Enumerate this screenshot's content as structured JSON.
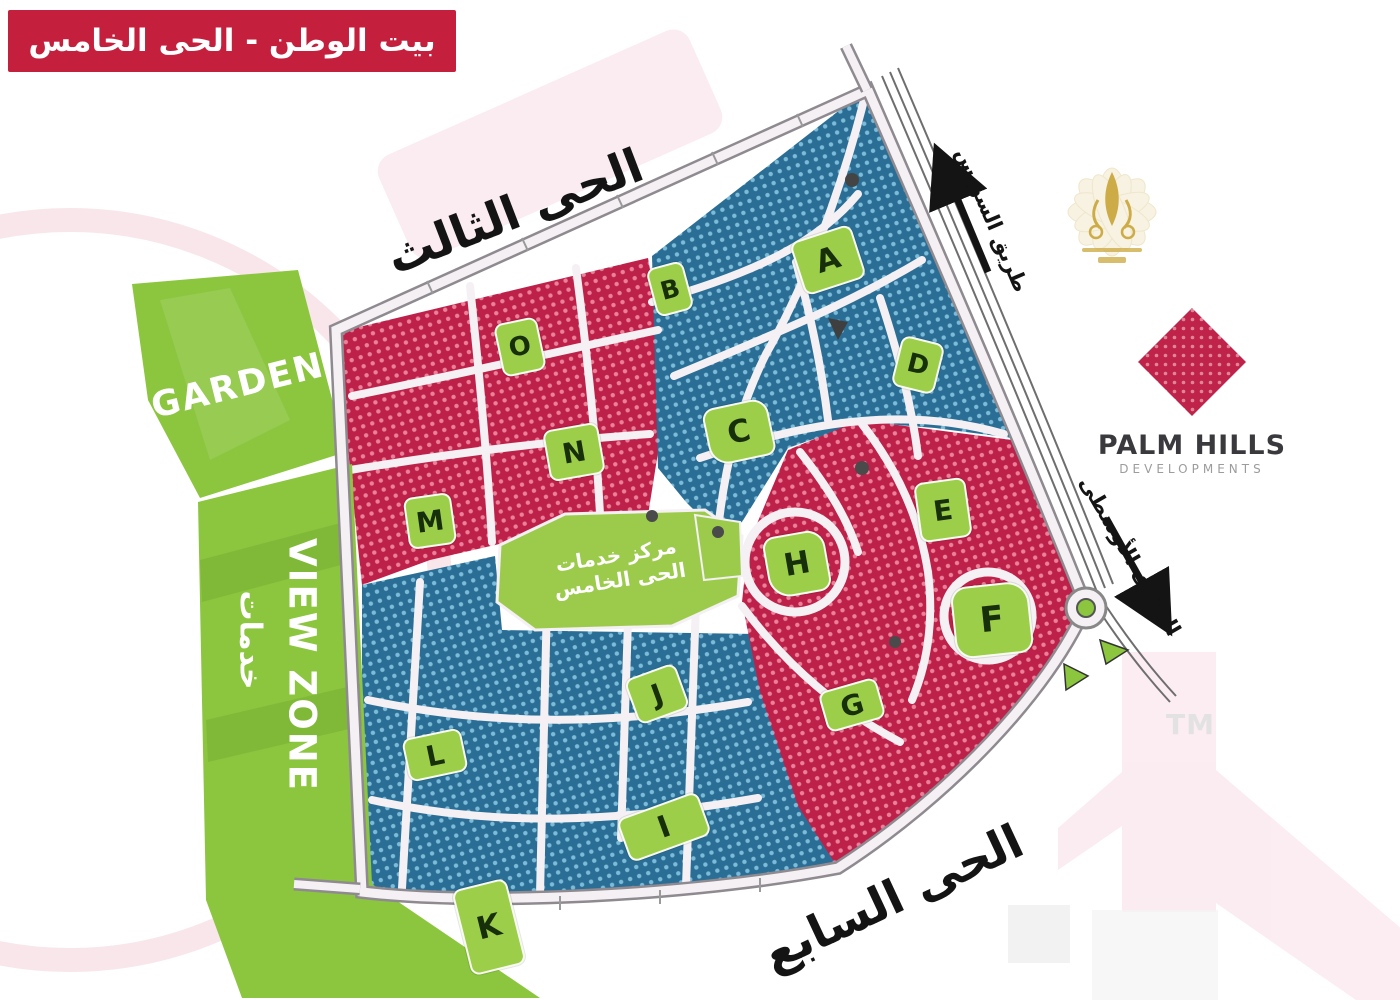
{
  "banner": {
    "title": "بيت الوطن - الحى الخامس"
  },
  "districts": {
    "top": "الحى الثالث",
    "bottom": "الحى السابع"
  },
  "roads": {
    "suez": "طريق السويس",
    "ring": "الدائرى الأوسطى"
  },
  "zones": {
    "garden": "GARDEN",
    "view_zone": "VIEW ZONE",
    "view_zone_ar": "خدمات",
    "services_line1": "مركز خدمات",
    "services_line2": "الحى الخامس"
  },
  "plots": [
    {
      "letter": "A"
    },
    {
      "letter": "B"
    },
    {
      "letter": "C"
    },
    {
      "letter": "D"
    },
    {
      "letter": "E"
    },
    {
      "letter": "F"
    },
    {
      "letter": "G"
    },
    {
      "letter": "H"
    },
    {
      "letter": "I"
    },
    {
      "letter": "J"
    },
    {
      "letter": "K"
    },
    {
      "letter": "L"
    },
    {
      "letter": "M"
    },
    {
      "letter": "N"
    },
    {
      "letter": "O"
    }
  ],
  "branding": {
    "name": "PALM HILLS",
    "division": "DEVELOPMENTS",
    "trademark": "TM"
  },
  "colors": {
    "banner_red": "#C4203E",
    "block_red": "#BD2048",
    "block_blue": "#2B6E95",
    "green_zone": "#8CC63F",
    "brand_crimson": "#C0234A"
  }
}
